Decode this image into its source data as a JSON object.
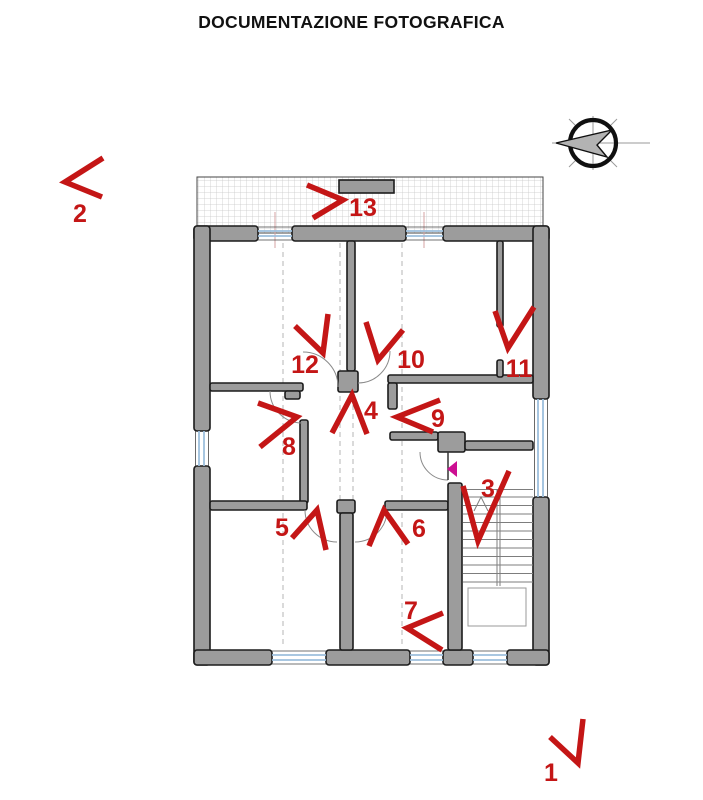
{
  "title": "DOCUMENTAZIONE FOTOGRAFICA",
  "colors": {
    "marker_red": "#c41616",
    "wall_gray": "#9c9c9c",
    "window_blue": "#9dbfdd",
    "entrance_pink": "#cc0f92"
  },
  "icons": {
    "compass": "north-arrow-icon",
    "entrance": "entrance-direction-arrow"
  },
  "markers": [
    {
      "label": "1",
      "label_x": 551,
      "label_y": 781,
      "arrow": "550,737 578,763 583,719"
    },
    {
      "label": "2",
      "label_x": 80,
      "label_y": 222,
      "arrow": "103,158 65,182 102,197"
    },
    {
      "label": "3",
      "label_x": 488,
      "label_y": 497,
      "arrow": "463,486 478,541 509,471"
    },
    {
      "label": "4",
      "label_x": 371,
      "label_y": 419,
      "arrow": "332,433 352,395 367,434"
    },
    {
      "label": "5",
      "label_x": 282,
      "label_y": 536,
      "arrow": "292,538 317,510 326,550"
    },
    {
      "label": "6",
      "label_x": 419,
      "label_y": 537,
      "arrow": "369,546 384,510 408,544"
    },
    {
      "label": "7",
      "label_x": 411,
      "label_y": 619,
      "arrow": "443,613 407,628 442,650"
    },
    {
      "label": "8",
      "label_x": 289,
      "label_y": 455,
      "arrow": "258,403 297,417 260,447"
    },
    {
      "label": "9",
      "label_x": 438,
      "label_y": 427,
      "arrow": "440,400 397,417 433,432"
    },
    {
      "label": "10",
      "label_x": 411,
      "label_y": 368,
      "arrow": "366,322 378,360 403,330"
    },
    {
      "label": "11",
      "label_x": 519,
      "label_y": 377,
      "arrow": "495,311 508,348 534,307"
    },
    {
      "label": "12",
      "label_x": 305,
      "label_y": 373,
      "arrow": "295,326 323,353 328,314"
    },
    {
      "label": "13",
      "label_x": 363,
      "label_y": 216,
      "arrow": "307,185 343,200 313,218"
    }
  ]
}
